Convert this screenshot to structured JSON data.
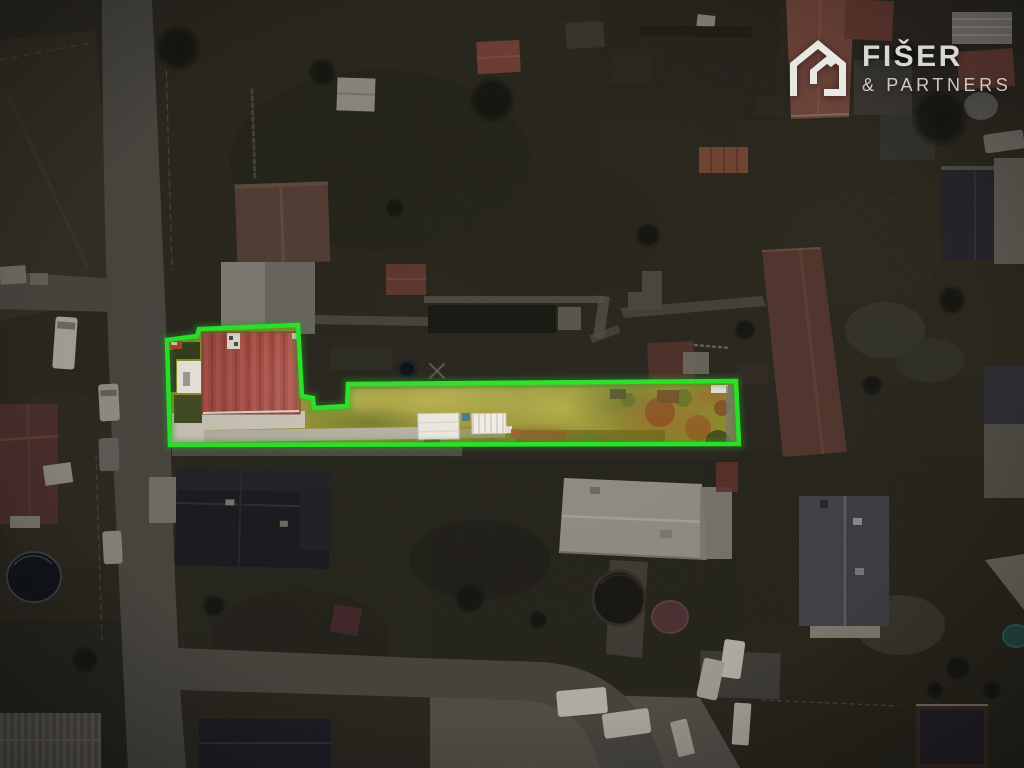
{
  "brand": {
    "name": "FIŠER",
    "suffix": "& PARTNERS",
    "icon": "house-logo-icon"
  },
  "colors": {
    "highlight_outline": "#26e626",
    "parcel_roof": "#a84a40",
    "parcel_grass": "#8e8e28",
    "photo_backdrop": "#26231c",
    "logo_text": "#d9d7d4"
  }
}
